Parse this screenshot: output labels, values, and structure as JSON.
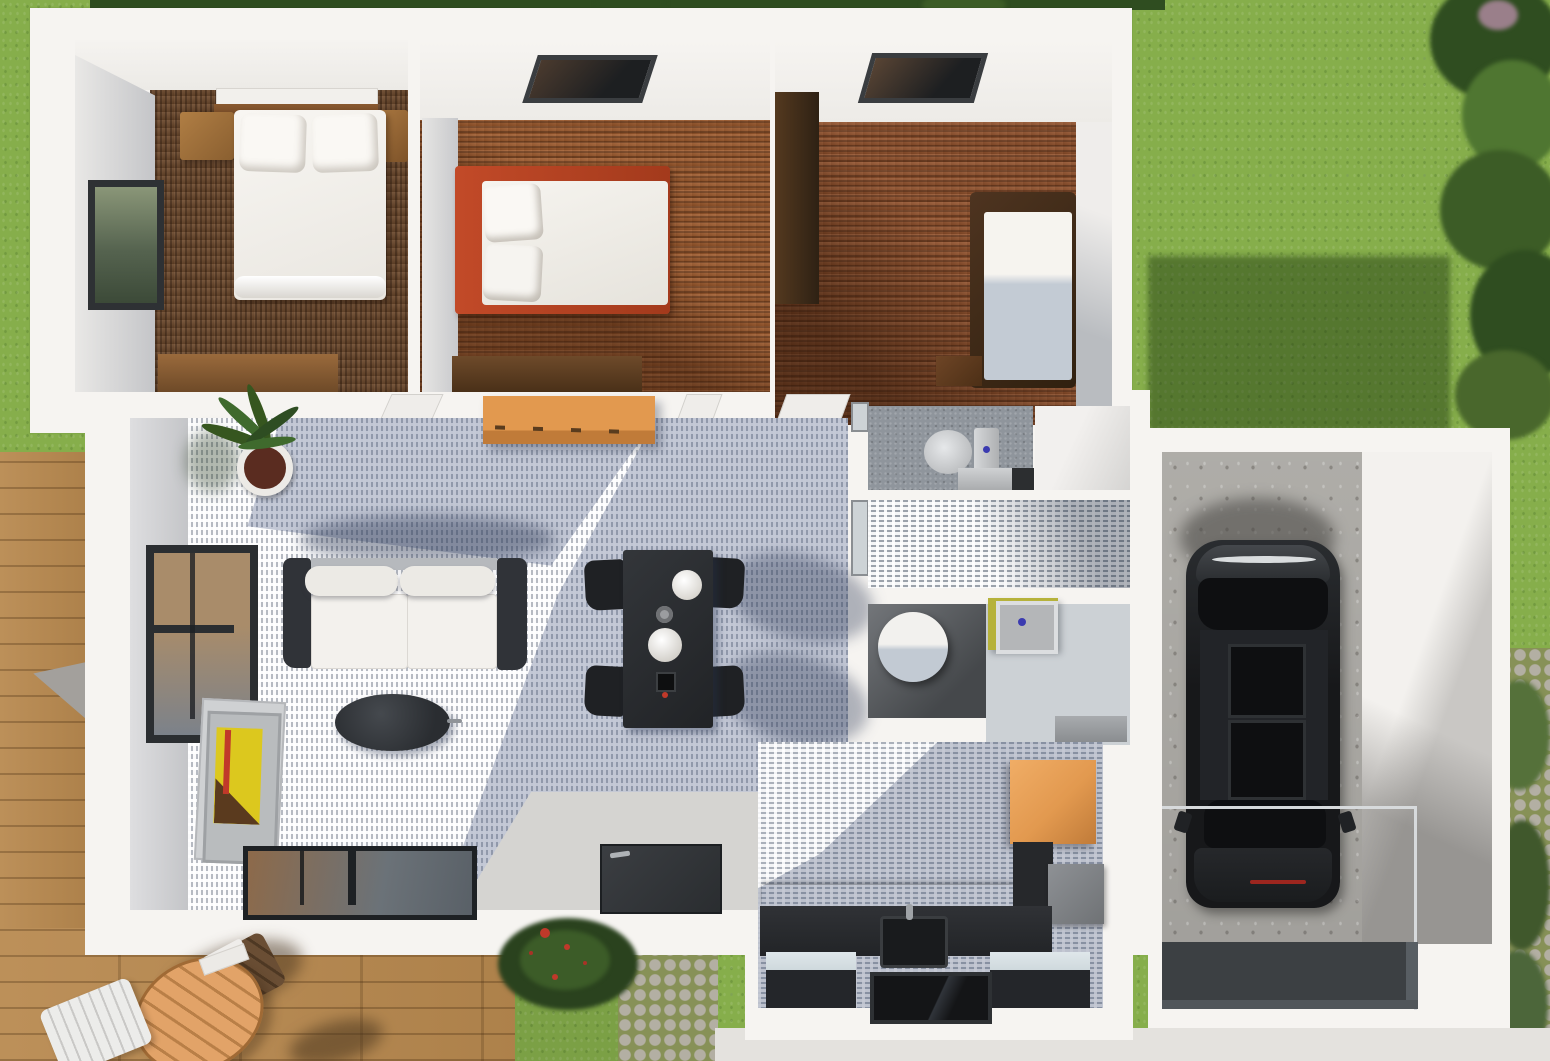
{
  "meta": {
    "width": 1550,
    "height": 1061,
    "description": "3D top-down architectural rendering of a single-story house floor plan with three bedrooms, living-dining room, bathroom, kitchen, attached garage with black car, wooden deck, lawn and cobblestone paths. No text is visible in the image."
  },
  "palette": {
    "lawn": "#86ae4b",
    "lawnShade": "#567f33",
    "hedge": "#2f4d20",
    "hedgeLight": "#4f7631",
    "deck": "#b8894f",
    "cobble": "#b3afa3",
    "cobbleGap": "#879157",
    "walkway": "#e4e2de",
    "wall": "#f6f4f1",
    "wallShade": "#d9d7d4",
    "wallFace": "#cfd0d3",
    "woodDark": "#6e492b",
    "oak": "#a05a2b",
    "tile": "#b6bac2",
    "bathFloor": "#8f959c",
    "bathTile": "#9ba2ab",
    "bathLight": "#ccd1d5",
    "kitchenTile": "#aab0ba",
    "orange": "#e2994f",
    "orangeSide": "#c07b39",
    "counter": "#27292c",
    "islandTop": "#cfd9dd",
    "black": "#1f2124",
    "sofa": "#303338",
    "cushion": "#f3f1ed",
    "redBed": "#c24a28",
    "yellowArt": "#dcc81e",
    "redAccent": "#c0392a",
    "sinkYellow": "#b6b23b",
    "blueDot": "#3b3bb0",
    "concrete": "#b8b6b1",
    "car": "#1b1d1f",
    "carGlass": "#0e0f11",
    "carTrim": "#d9dcde",
    "ramp": "#3c4043",
    "glassTan": "#a98c6a",
    "glassGray": "#7c828a",
    "frameDark": "#2b2e31",
    "white": "#f8f6f2",
    "plantGreen": "#36561f",
    "potBrown": "#5a2c20"
  },
  "scene": {
    "yard": {
      "areas": [
        "lawn",
        "hedge-row",
        "cobblestone-path",
        "wood-deck",
        "stone-walkway",
        "flowering-shrub"
      ],
      "furniture": [
        "round-slatted-table",
        "white-deck-chair",
        "brown-deck-chair"
      ]
    },
    "house": {
      "rooms": [
        {
          "name": "bedroom-1",
          "floor": "dark-walnut-planks",
          "objects": [
            "double-bed",
            "pillows",
            "headboard-shelf",
            "nightstand-left",
            "nightstand-right",
            "dresser",
            "window"
          ]
        },
        {
          "name": "bedroom-2",
          "floor": "oak-planks",
          "objects": [
            "bed-red-frame",
            "pillows",
            "dresser",
            "skylight"
          ]
        },
        {
          "name": "bedroom-3",
          "floor": "oak-planks",
          "objects": [
            "wardrobe",
            "single-bed",
            "nightstand",
            "skylight"
          ]
        },
        {
          "name": "living-dining",
          "floor": "gray-tile",
          "objects": [
            "sofa",
            "coffee-table",
            "potted-plant",
            "sideboard",
            "dining-table",
            "dining-chairs",
            "plates",
            "picture-frames",
            "window",
            "sliding-glass-door",
            "front-door"
          ]
        },
        {
          "name": "wc",
          "objects": [
            "toilet",
            "cistern",
            "shelf"
          ]
        },
        {
          "name": "bathroom",
          "objects": [
            "washbasin",
            "water-heater-cylinder",
            "cabinet"
          ]
        },
        {
          "name": "kitchen",
          "objects": [
            "black-counter",
            "sink",
            "cooktop",
            "island-unit-left",
            "island-unit-right",
            "orange-cabinets",
            "appliance"
          ]
        },
        {
          "name": "garage",
          "objects": [
            "black-car",
            "glass-railing",
            "driveway-ramp",
            "concrete-floor"
          ]
        }
      ]
    }
  }
}
